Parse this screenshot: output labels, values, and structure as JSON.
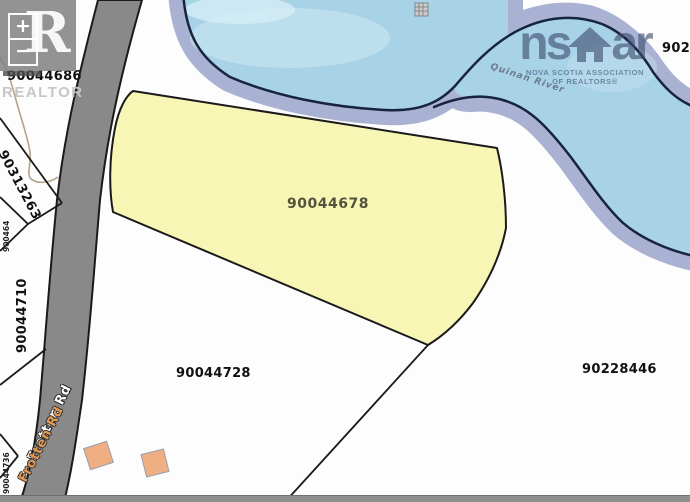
{
  "app": {
    "type": "property-parcel-map"
  },
  "controls": {
    "zoom_in_label": "+",
    "zoom_out_label": "−"
  },
  "watermarks": {
    "realtor_letter": "R",
    "realtor_label": "REALTOR",
    "nsar_left": "ns",
    "nsar_right": "ar",
    "nsar_line1": "NOVA SCOTIA ASSOCIATION",
    "nsar_line2": "OF REALTORS®"
  },
  "parcels": {
    "highlighted": {
      "id": "90044678"
    },
    "south": {
      "id": "90044728"
    },
    "southeast": {
      "id": "90228446"
    },
    "northwest": {
      "id": "90044686"
    },
    "west_wedge": {
      "id": "90313263"
    },
    "west": {
      "id": "90044710"
    },
    "west_edge_small": {
      "id": "900464"
    },
    "southwest_edge": {
      "id": "90044736"
    },
    "northeast_partial": {
      "id": "902"
    }
  },
  "roads": {
    "primary": {
      "name": "Frotten Rd"
    },
    "street_layer": {
      "name": "Frotten Rd"
    }
  },
  "water": {
    "label": "Quinan River"
  },
  "colors": {
    "highlight_parcel": "#f8f6b4",
    "water": "#a8d2e6",
    "water_shallow": "#cde7f3",
    "water_buffer": "#a9b2d2",
    "shoreline": "#16243f",
    "road": "#898989",
    "building": "#f0ae83",
    "bottom_bar": "#8e8e8e"
  }
}
